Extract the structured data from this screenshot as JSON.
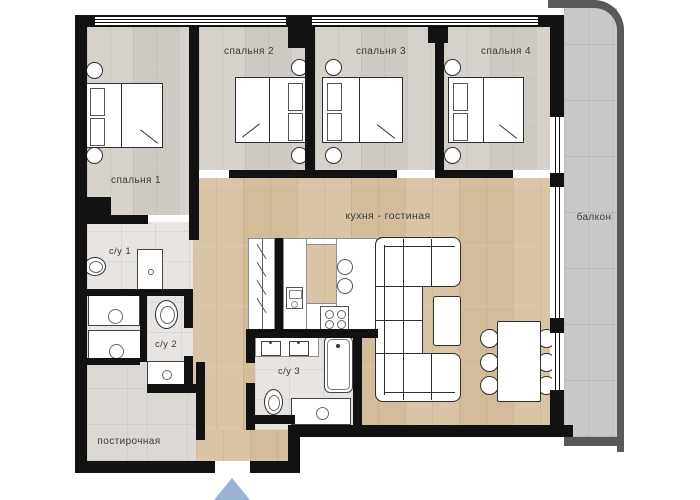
{
  "rooms": {
    "bedroom1": {
      "label": "спальня 1"
    },
    "bedroom2": {
      "label": "спальня 2"
    },
    "bedroom3": {
      "label": "спальня 3"
    },
    "bedroom4": {
      "label": "спальня 4"
    },
    "kitchen_living": {
      "label": "кухня - гостиная"
    },
    "bathroom1": {
      "label": "с/у 1"
    },
    "bathroom2": {
      "label": "с/у 2"
    },
    "bathroom3": {
      "label": "с/у 3"
    },
    "laundry": {
      "label": "постирочная"
    },
    "balcony": {
      "label": "балкон"
    }
  },
  "colors": {
    "wall": "#121212",
    "bedroom_floor": "#d3cdc7",
    "living_floor": "#d6c1a1",
    "bathroom_tile": "#e7e4e1",
    "laundry_tile": "#dcd8d4",
    "balcony_floor": "#c9c9c9",
    "balcony_outer_wall": "#59595b",
    "entrance_arrow": "#9ab2d4",
    "furniture_fill": "#ffffff",
    "furniture_outline": "#2f2f2f"
  },
  "icons": {
    "entrance": "entrance-arrow"
  }
}
